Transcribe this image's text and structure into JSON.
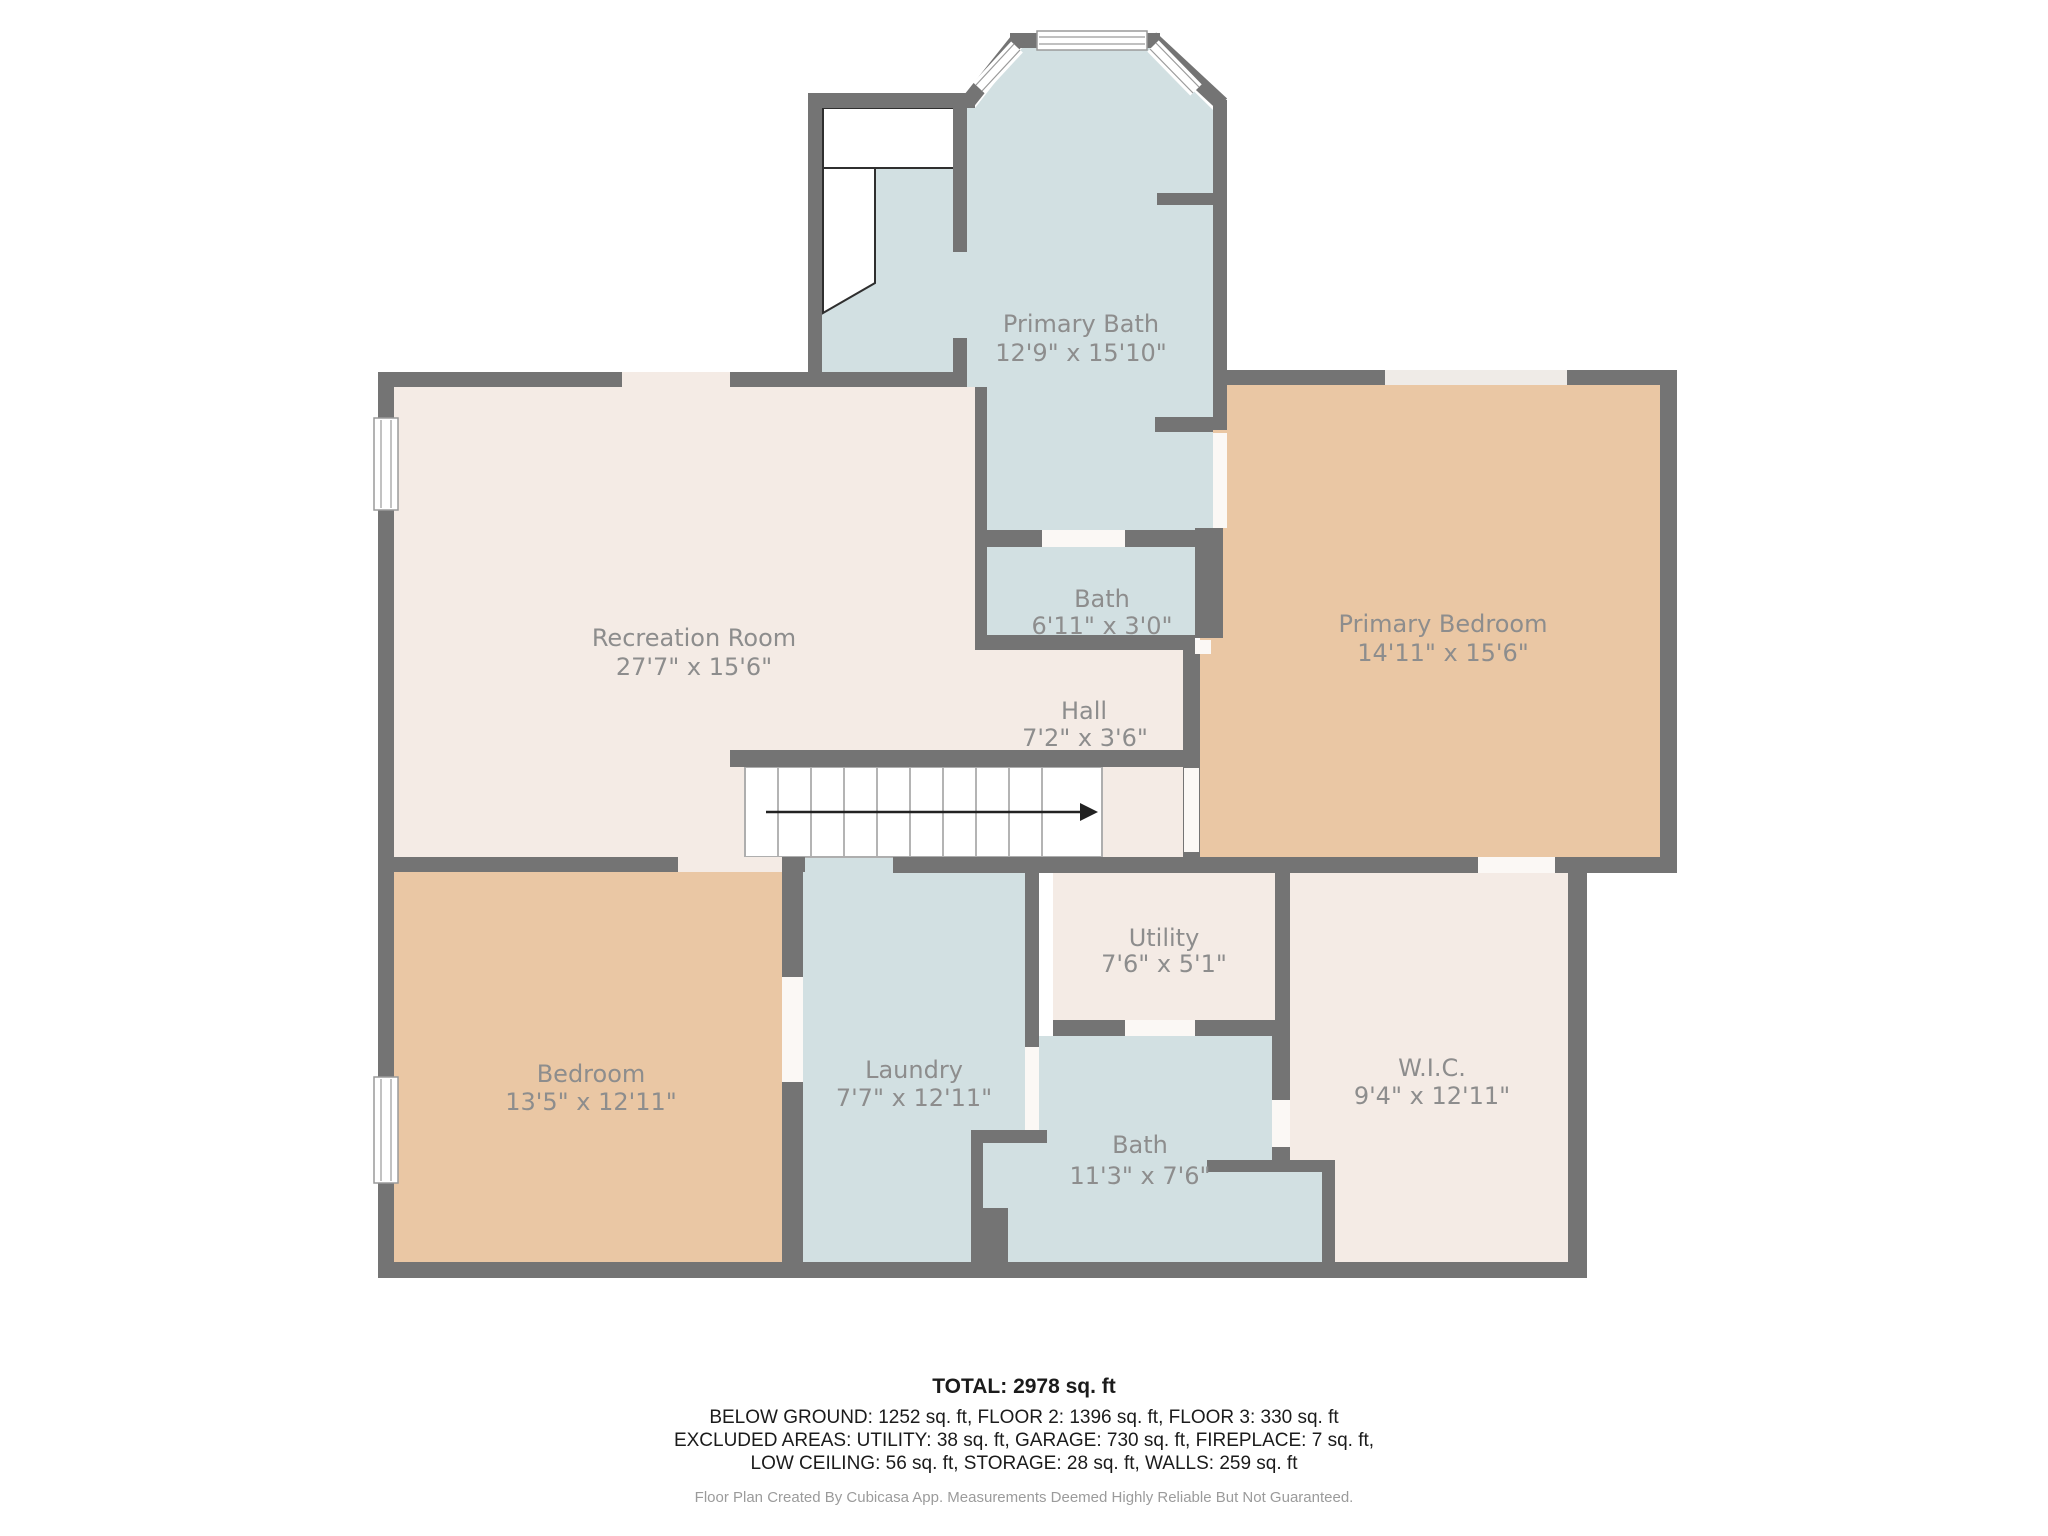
{
  "document": {
    "type": "floor-plan",
    "creator_note": "Floor Plan Created By Cubicasa App. Measurements Deemed Highly Reliable But Not Guaranteed."
  },
  "colors": {
    "wall": "#747474",
    "floor_pink": "#f4ebe5",
    "floor_blue": "#d2e0e2",
    "floor_tan": "#eac7a4",
    "door_gap_white": "#fbf8f5",
    "window_gap_light": "#efebe7",
    "label_text": "#8d8d8d",
    "footer_text": "#1b1b1b",
    "credit_text": "#9b9b9b"
  },
  "rooms": [
    {
      "id": "primary-bath",
      "name": "Primary Bath",
      "dims": "12'9\" x 15'10\"",
      "floor": "blue"
    },
    {
      "id": "bath-upper",
      "name": "Bath",
      "dims": "6'11\" x 3'0\"",
      "floor": "blue"
    },
    {
      "id": "recreation",
      "name": "Recreation Room",
      "dims": "27'7\" x 15'6\"",
      "floor": "pink"
    },
    {
      "id": "primary-bedroom",
      "name": "Primary Bedroom",
      "dims": "14'11\" x 15'6\"",
      "floor": "tan"
    },
    {
      "id": "hall",
      "name": "Hall",
      "dims": "7'2\" x 3'6\"",
      "floor": "pink"
    },
    {
      "id": "utility",
      "name": "Utility",
      "dims": "7'6\" x 5'1\"",
      "floor": "pink"
    },
    {
      "id": "laundry",
      "name": "Laundry",
      "dims": "7'7\" x 12'11\"",
      "floor": "blue"
    },
    {
      "id": "bath-lower",
      "name": "Bath",
      "dims": "11'3\" x 7'6\"",
      "floor": "blue"
    },
    {
      "id": "wic",
      "name": "W.I.C.",
      "dims": "9'4\" x 12'11\"",
      "floor": "pink"
    },
    {
      "id": "bedroom",
      "name": "Bedroom",
      "dims": "13'5\" x 12'11\"",
      "floor": "tan"
    }
  ],
  "stairs": {
    "direction": "down-to-right",
    "treads": 10
  },
  "footer": {
    "total": "TOTAL: 2978 sq. ft",
    "line1": "BELOW GROUND: 1252 sq. ft, FLOOR 2: 1396 sq. ft, FLOOR 3: 330 sq. ft",
    "line2": "EXCLUDED AREAS: UTILITY: 38 sq. ft, GARAGE: 730 sq. ft, FIREPLACE: 7 sq. ft,",
    "line3": "LOW CEILING: 56 sq. ft, STORAGE: 28 sq. ft, WALLS: 259 sq. ft",
    "credit": "Floor Plan Created By Cubicasa App. Measurements Deemed Highly Reliable But Not Guaranteed."
  }
}
